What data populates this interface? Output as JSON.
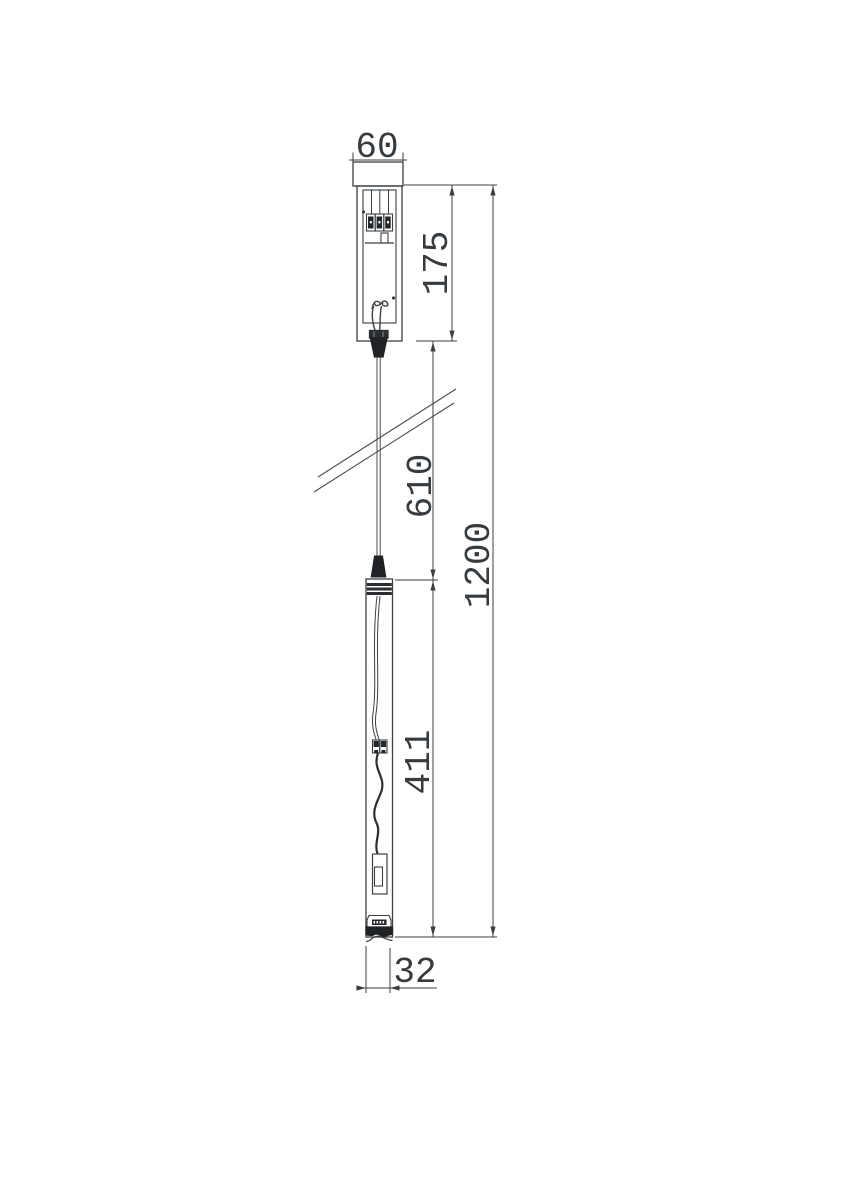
{
  "drawing": {
    "title": "pendant-lamp-dimension-drawing",
    "background_color": "#ffffff",
    "line_color": "#3b4045",
    "dark_fill_color": "#202327",
    "dimensions": {
      "canopy_width_mm": "60",
      "canopy_height_mm": "175",
      "suspension_length_mm": "610",
      "lamp_body_length_mm": "411",
      "overall_height_mm": "1200",
      "lamp_diameter_mm": "32"
    }
  }
}
